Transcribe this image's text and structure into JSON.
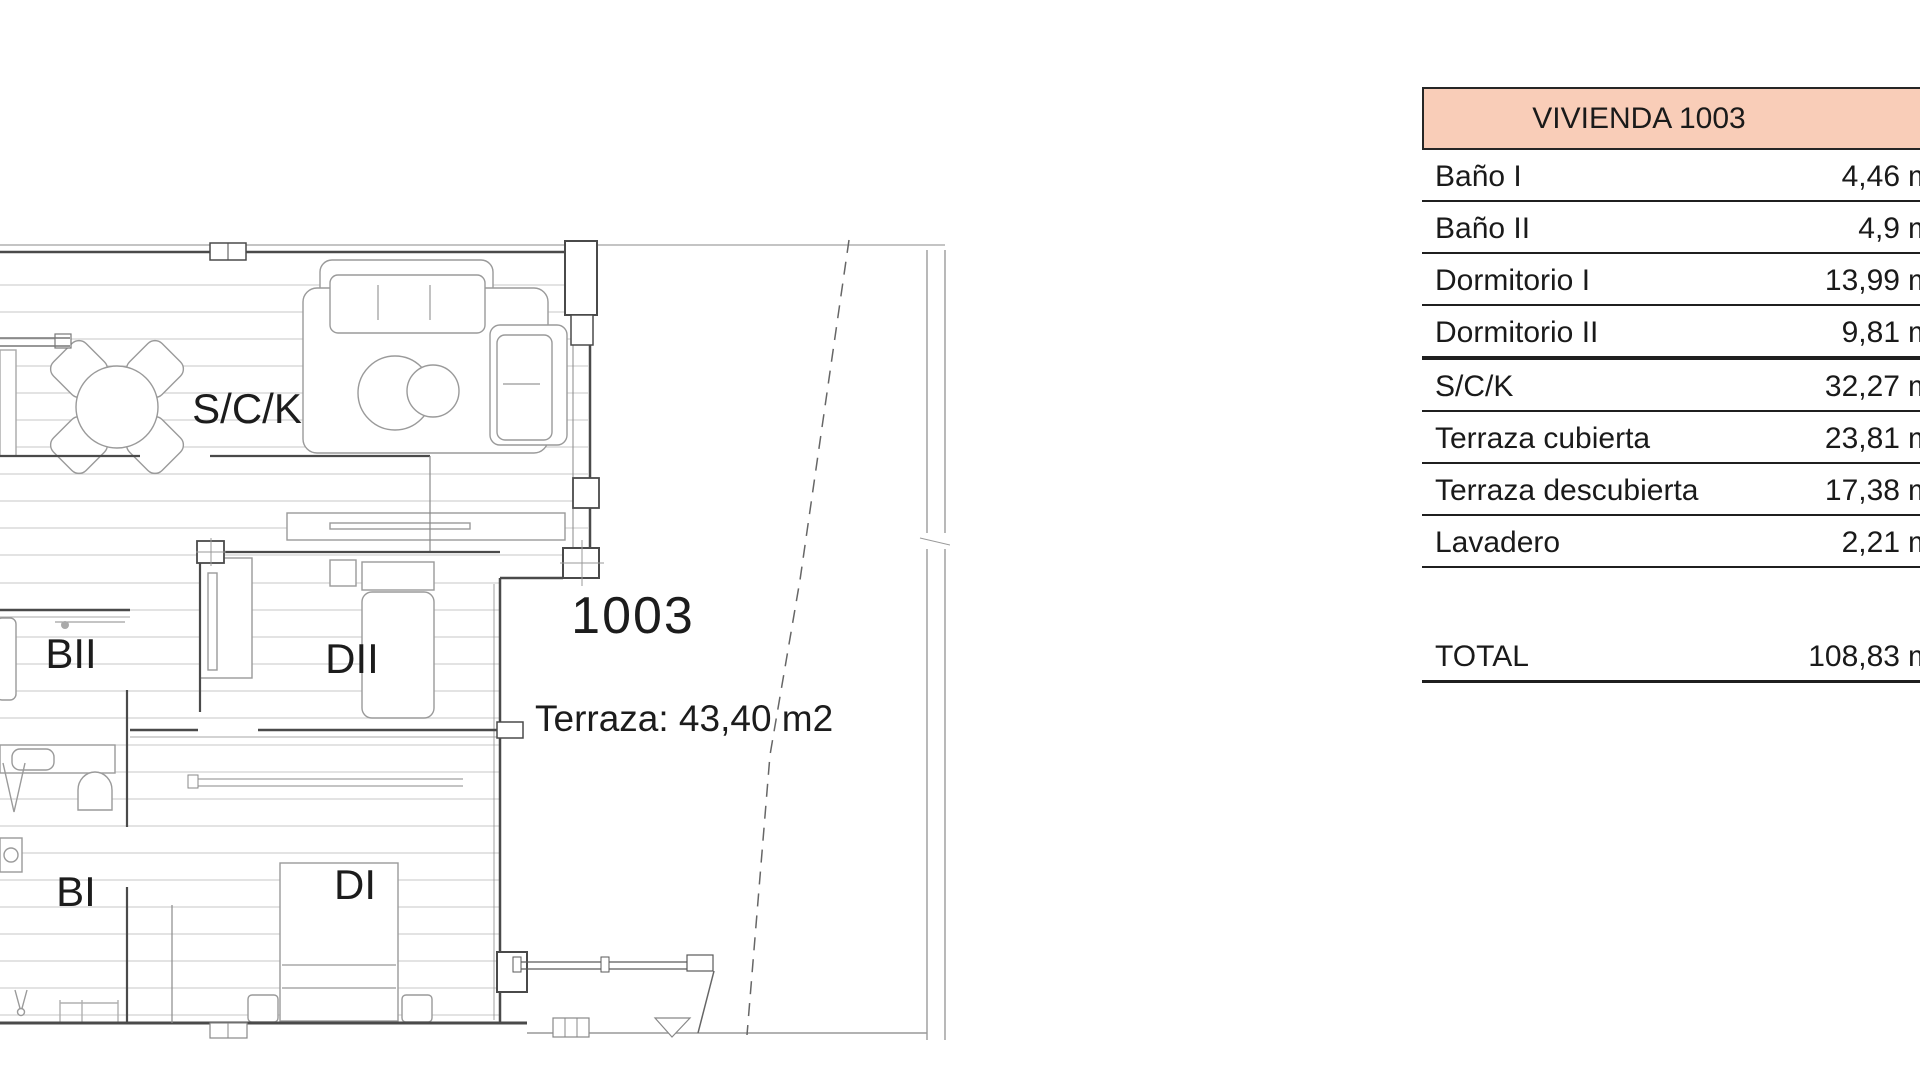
{
  "floor_plan": {
    "unit_number": "1003",
    "unit_number_color": "#c02b2b",
    "terrace_label": "Terraza: 43,40 m2",
    "room_labels": [
      {
        "id": "sck",
        "text": "S/C/K"
      },
      {
        "id": "bii",
        "text": "BII"
      },
      {
        "id": "dii",
        "text": "DII"
      },
      {
        "id": "bi",
        "text": "BI"
      },
      {
        "id": "di",
        "text": "DI"
      }
    ]
  },
  "area_table": {
    "title": "VIVIENDA 1003",
    "header_bg": "#f9cdb8",
    "unit": "m2",
    "rows": [
      {
        "label": "Baño I",
        "value": "4,46"
      },
      {
        "label": "Baño II",
        "value": "4,9"
      },
      {
        "label": "Dormitorio I",
        "value": "13,99"
      },
      {
        "label": "Dormitorio II",
        "value": "9,81",
        "thick": true
      },
      {
        "label": "S/C/K",
        "value": "32,27"
      },
      {
        "label": "Terraza cubierta",
        "value": "23,81"
      },
      {
        "label": "Terraza descubierta",
        "value": "17,38"
      },
      {
        "label": "Lavadero",
        "value": "2,21"
      }
    ],
    "total": {
      "label": "TOTAL",
      "value": "108,83"
    }
  }
}
